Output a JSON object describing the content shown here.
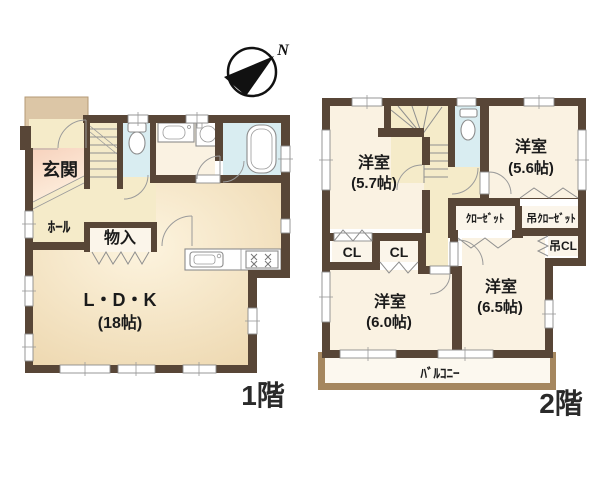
{
  "compass": {
    "label": "N"
  },
  "floor1": {
    "caption": "1階",
    "entrance": "玄関",
    "hall": "ﾎｰﾙ",
    "storage": "物入",
    "ldk_name": "L・D・K",
    "ldk_size": "(18帖)"
  },
  "floor2": {
    "caption": "2階",
    "room_nw_name": "洋室",
    "room_nw_size": "(5.7帖)",
    "room_ne_name": "洋室",
    "room_ne_size": "(5.6帖)",
    "room_sw_name": "洋室",
    "room_sw_size": "(6.0帖)",
    "room_se_name": "洋室",
    "room_se_size": "(6.5帖)",
    "cl_left": "CL",
    "cl_right": "CL",
    "closet": "ｸﾛｰｾﾞｯﾄ",
    "hanging_closet": "吊ｸﾛｰｾﾞｯﾄ",
    "hanging_cl": "吊CL",
    "balcony": "ﾊﾞﾙｺﾆｰ"
  },
  "colors": {
    "wall": "#584637",
    "water_blue": "#d9edf1",
    "hall_yellow": "#f5ebc9",
    "ldk_tan": "#efdab4",
    "genkan_pink": "#f8d8c6",
    "porch_tan": "#dcc6a6",
    "room_cream": "#faf2e2",
    "closet_cream": "#fbf5ea",
    "balcony_trim": "#a5875f"
  }
}
